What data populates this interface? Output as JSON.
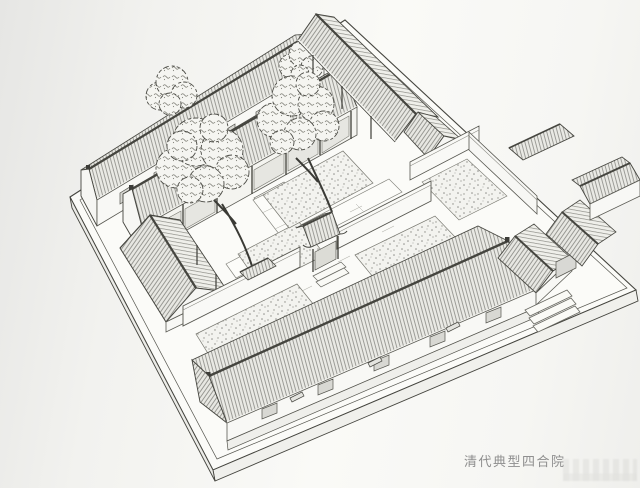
{
  "figure": {
    "caption": "清代典型四合院"
  },
  "style": {
    "ink_color": "#45453f",
    "paper_color": "#f4f4f0",
    "caption_color": "#8f8f8f"
  },
  "illustration": {
    "type": "axonometric-line-drawing",
    "subject": "typical Qing dynasty siheyuan courtyard house",
    "parts": [
      "rear-row-building",
      "north-hall",
      "east-wing",
      "west-wing",
      "inner-gate",
      "dividing-wall",
      "front-row-building",
      "entrance-gate",
      "entrance-steps",
      "courtyard-trees",
      "planting-beds",
      "paved-paths",
      "base-platform"
    ]
  }
}
